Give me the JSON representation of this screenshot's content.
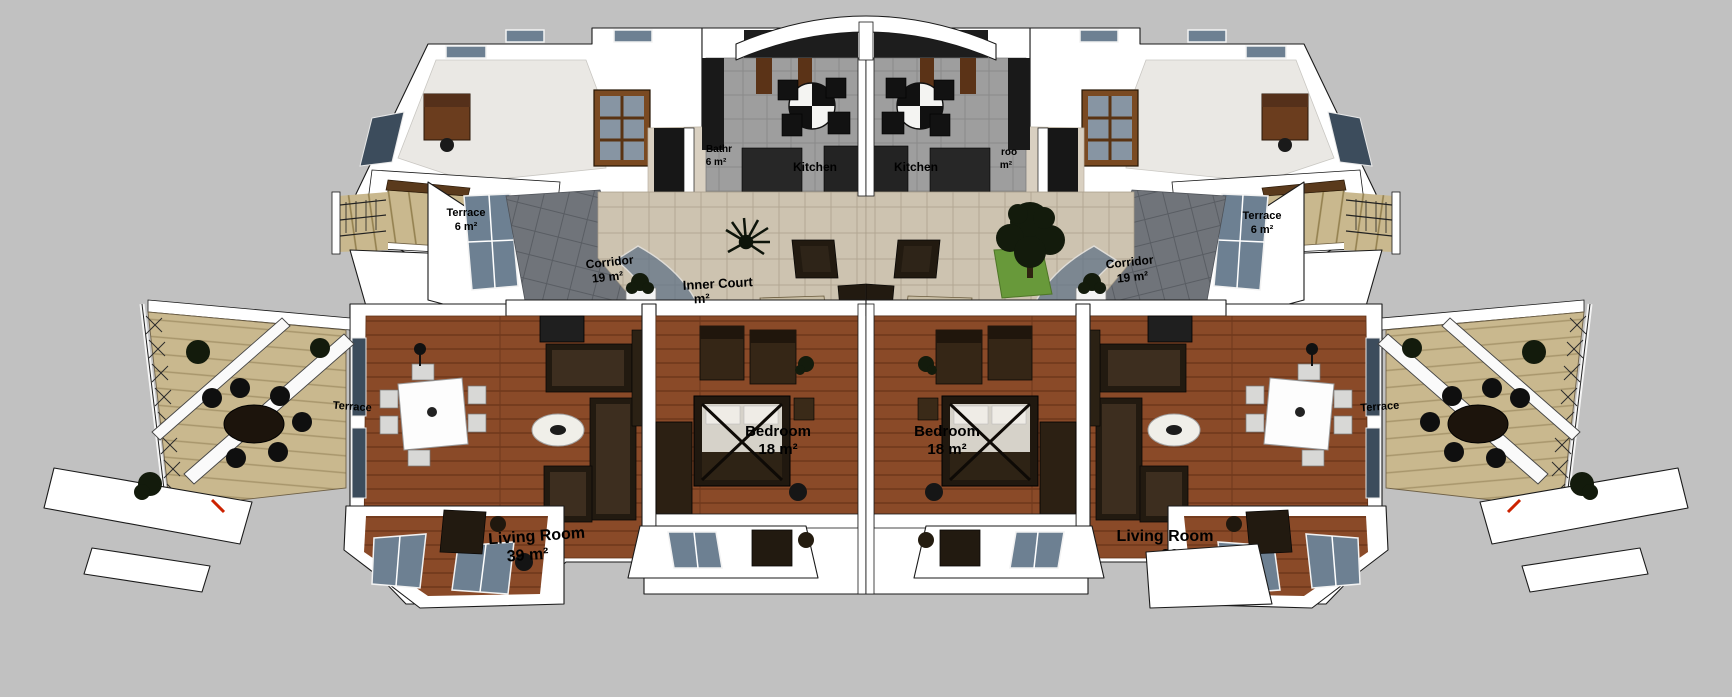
{
  "colors": {
    "background": "#c1c1c1",
    "wall": "#ffffff",
    "outline": "#1a1a1a",
    "wood": "#8a4a28",
    "court_tile": "#cdc3b0",
    "corridor_tile": "#70747a",
    "kitchen_tile": "#9e9e9e",
    "terrace_wood": "#c9b88e",
    "glass": "#6d8092",
    "dark_furniture": "#221a10",
    "foliage": "#131b0c",
    "grass": "#68993a",
    "label": "#000000"
  },
  "labels": {
    "terrace_upper_left": {
      "line1": "Terrace",
      "line2": "6 m²"
    },
    "terrace_upper_right": {
      "line1": "Terrace",
      "line2": "6 m²"
    },
    "bathroom_left": {
      "line1": "Bathr",
      "line2": "6 m²"
    },
    "bathroom_right": {
      "line1": "roo",
      "line2": "m²"
    },
    "kitchen_left": {
      "line1": "Kitchen"
    },
    "kitchen_right": {
      "line1": "Kitchen"
    },
    "corridor_left": {
      "line1": "Corridor",
      "line2": "19 m²"
    },
    "corridor_right": {
      "line1": "Corridor",
      "line2": "19 m²"
    },
    "inner_court": {
      "line1": "Inner Court",
      "line2": "m²"
    },
    "bedroom_left": {
      "line1": "Bedroom",
      "line2": "18 m²"
    },
    "bedroom_right": {
      "line1": "Bedroom",
      "line2": "18 m²"
    },
    "living_left": {
      "line1": "Living Room",
      "line2": "39 m²"
    },
    "living_right": {
      "line1": "Living Room",
      "line2": "39 m²"
    },
    "terrace_side_left": {
      "line1": "Terrace"
    },
    "terrace_side_right": {
      "line1": "Terrace"
    }
  }
}
